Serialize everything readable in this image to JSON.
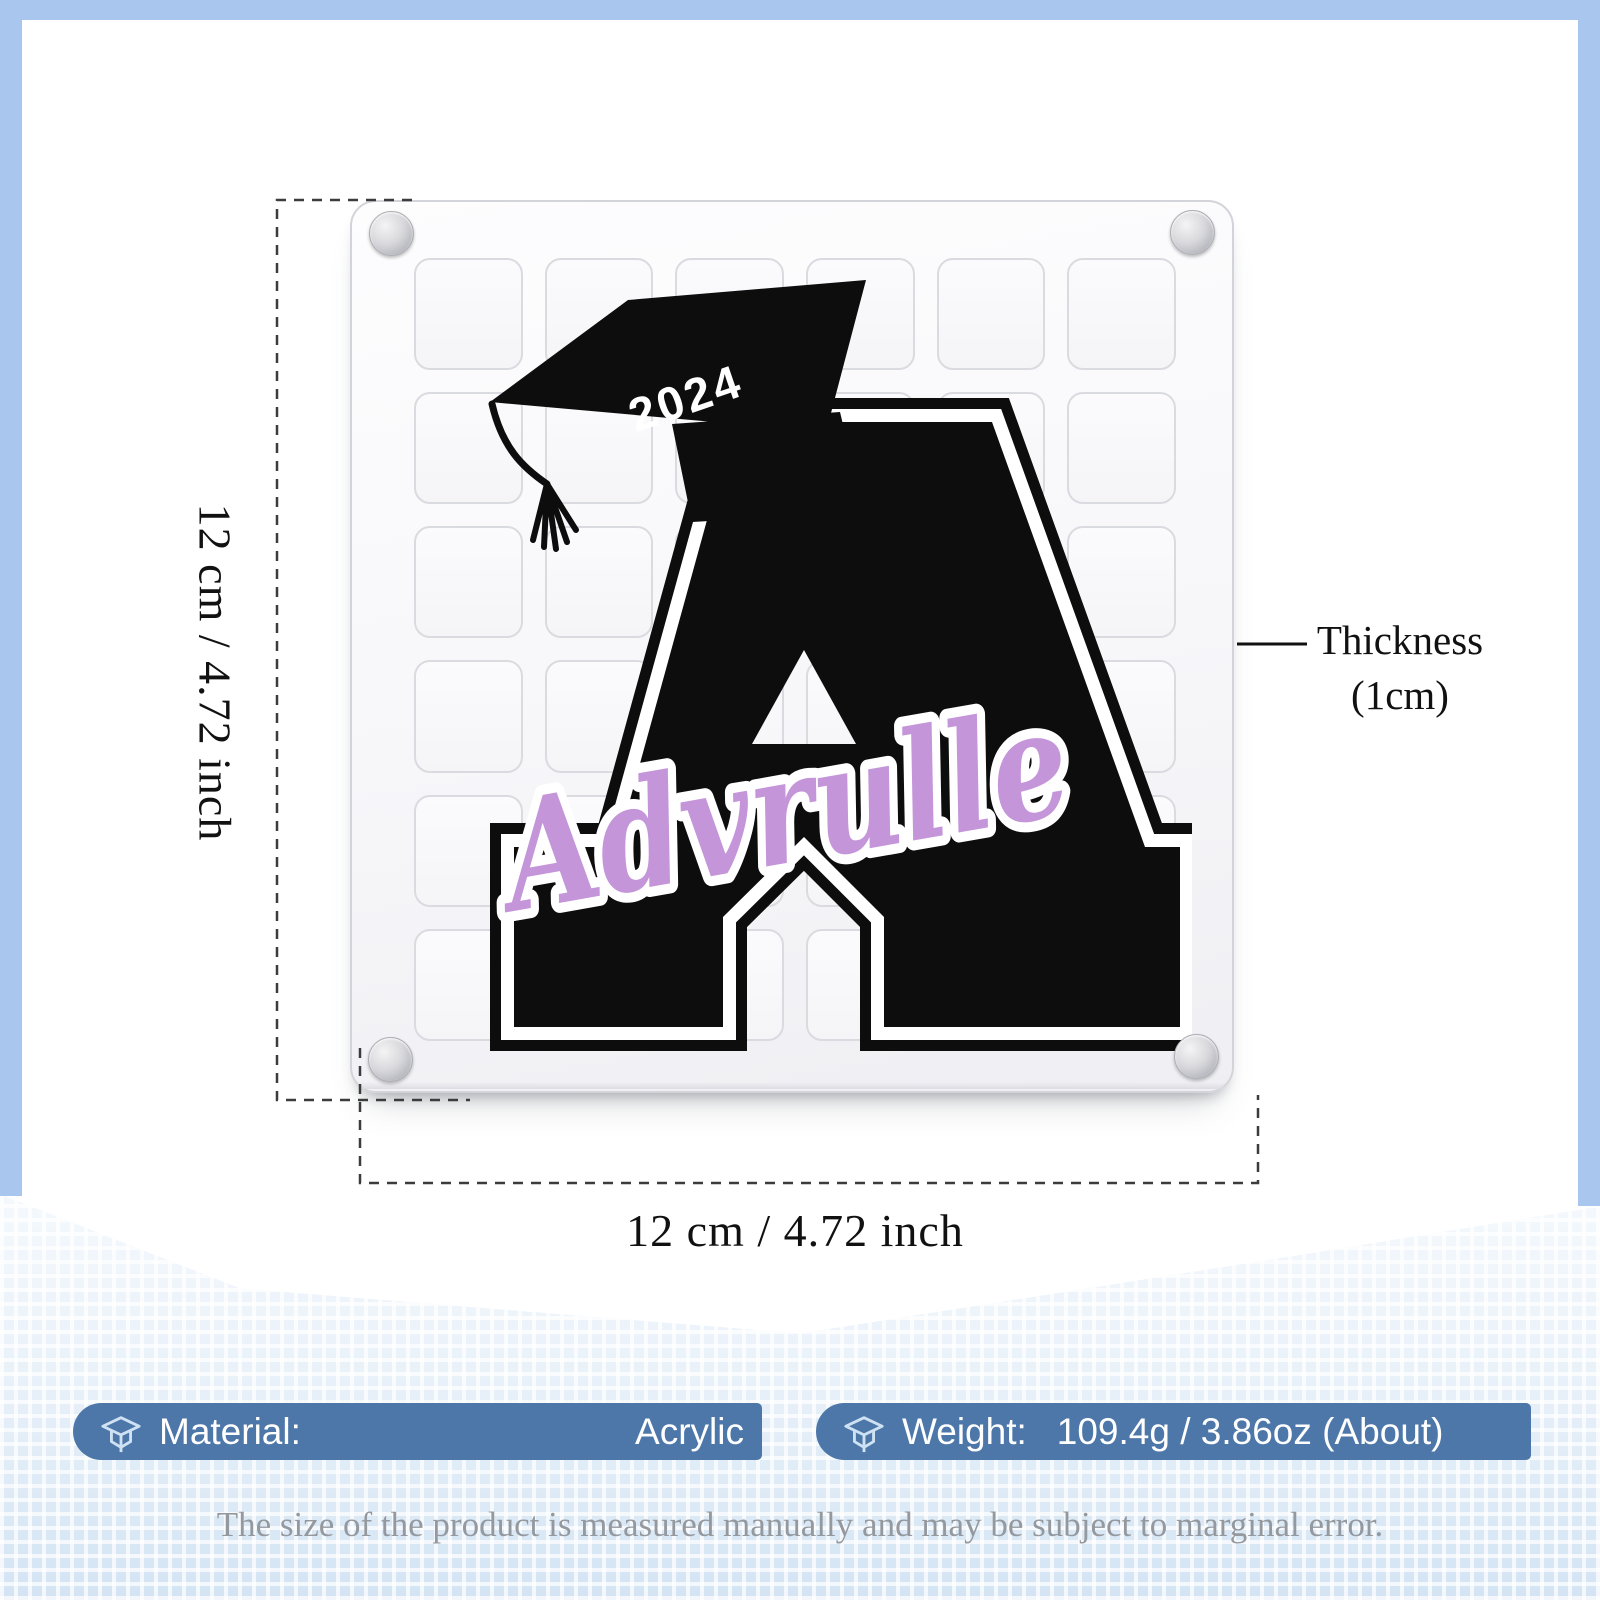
{
  "artwork": {
    "year": "2024",
    "name": "Advrulle"
  },
  "dimensions": {
    "height": "12 cm / 4.72 inch",
    "width": "12 cm / 4.72 inch",
    "thickness_label": "Thickness",
    "thickness_value": "(1cm)"
  },
  "specs": {
    "material_label": "Material:",
    "material_value": "Acrylic",
    "weight_label": "Weight:",
    "weight_value": "109.4g / 3.86oz (About)"
  },
  "footer_note": "The size of the product is measured manually and may be subject to marginal error.",
  "plaque": {
    "grid_rows": 6,
    "grid_cols": 6
  },
  "colors": {
    "bar_blue": "#4d77a9",
    "frame_blue": "#a9c7ee",
    "name_purple": "#c495d9",
    "letter_black": "#0d0d0d"
  }
}
